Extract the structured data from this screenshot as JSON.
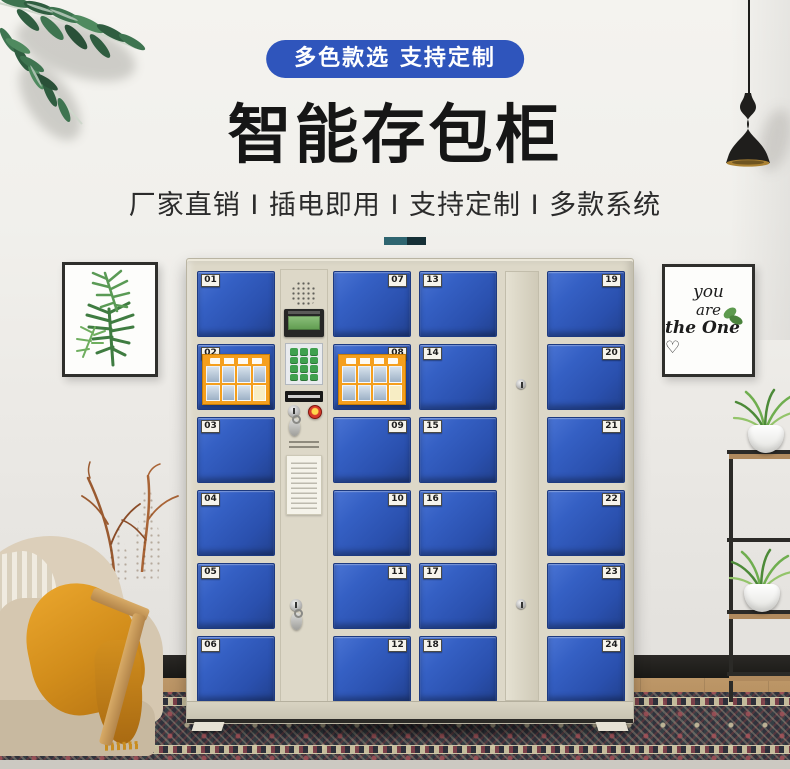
{
  "banner": {
    "text": "多色款选 支持定制",
    "bg_color": "#2f55bc"
  },
  "header": {
    "title": "智能存包柜",
    "subtitle": "厂家直销 I 插电即用 I 支持定制 I 多款系统"
  },
  "divider_colors": [
    "#2e6570",
    "#152f36"
  ],
  "art": {
    "right_frame_lines": [
      "you",
      "are",
      "the One ♡"
    ]
  },
  "locker": {
    "colors": {
      "door_blue": "#2c55b6",
      "frame_beige": "#ddd8c8",
      "poster_orange": "#f59f1d"
    },
    "columns": [
      {
        "kind": "doors",
        "plate_side": "left",
        "numbers": [
          "01",
          "02",
          "03",
          "04",
          "05",
          "06"
        ],
        "poster_on": "02"
      },
      {
        "kind": "control"
      },
      {
        "kind": "doors",
        "plate_side": "right",
        "numbers": [
          "07",
          "08",
          "09",
          "10",
          "11",
          "12"
        ],
        "poster_on": "08"
      },
      {
        "kind": "doors",
        "plate_side": "left",
        "numbers": [
          "13",
          "14",
          "15",
          "16",
          "17",
          "18"
        ]
      },
      {
        "kind": "master"
      },
      {
        "kind": "doors",
        "plate_side": "right",
        "numbers": [
          "19",
          "20",
          "21",
          "22",
          "23",
          "24"
        ]
      }
    ]
  }
}
